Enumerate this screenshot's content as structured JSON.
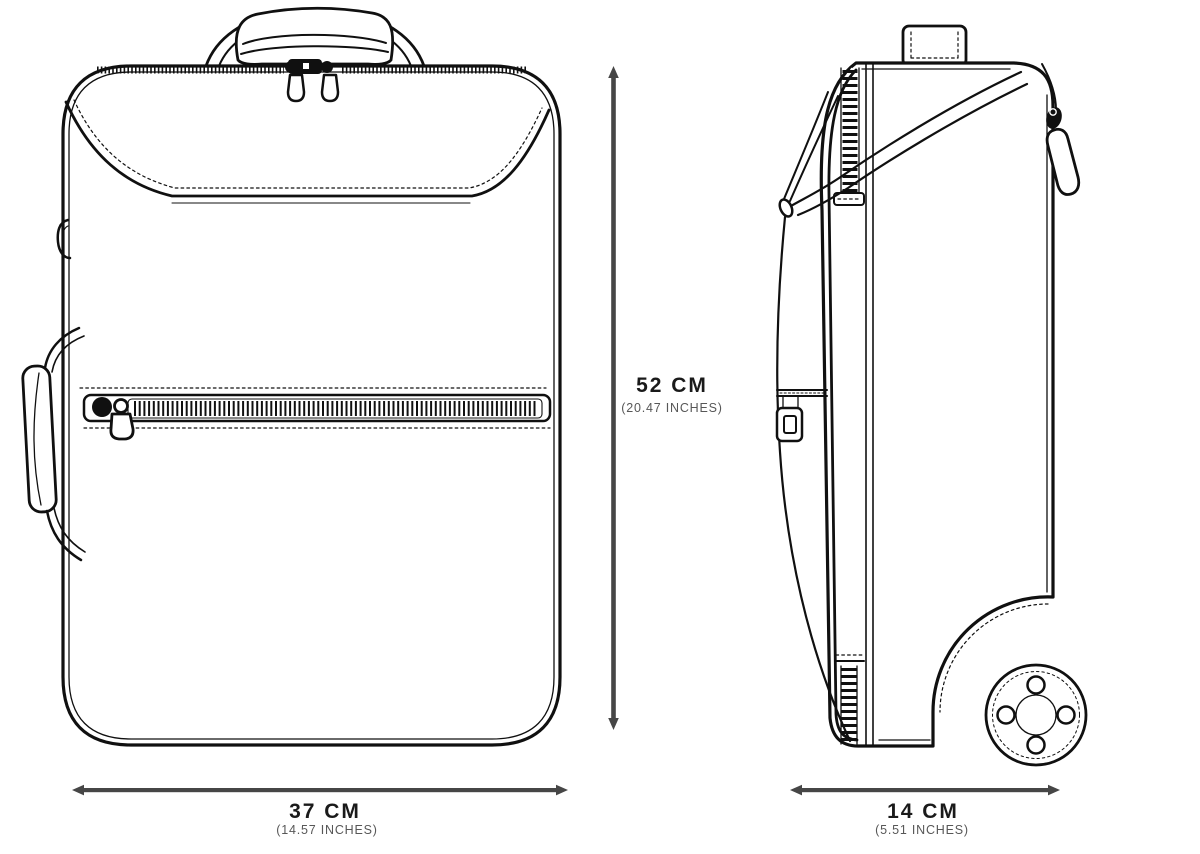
{
  "dimensions": {
    "height": {
      "value": "52 CM",
      "inches": "(20.47 INCHES)"
    },
    "width": {
      "value": "37 CM",
      "inches": "(14.57 INCHES)"
    },
    "depth": {
      "value": "14 CM",
      "inches": "(5.51 INCHES)"
    }
  },
  "colors": {
    "line_art": "#101010",
    "dimension_line": "#464646",
    "primary_label_text": "#1a1a1a",
    "secondary_label_text": "#575757",
    "background": "#ffffff"
  }
}
